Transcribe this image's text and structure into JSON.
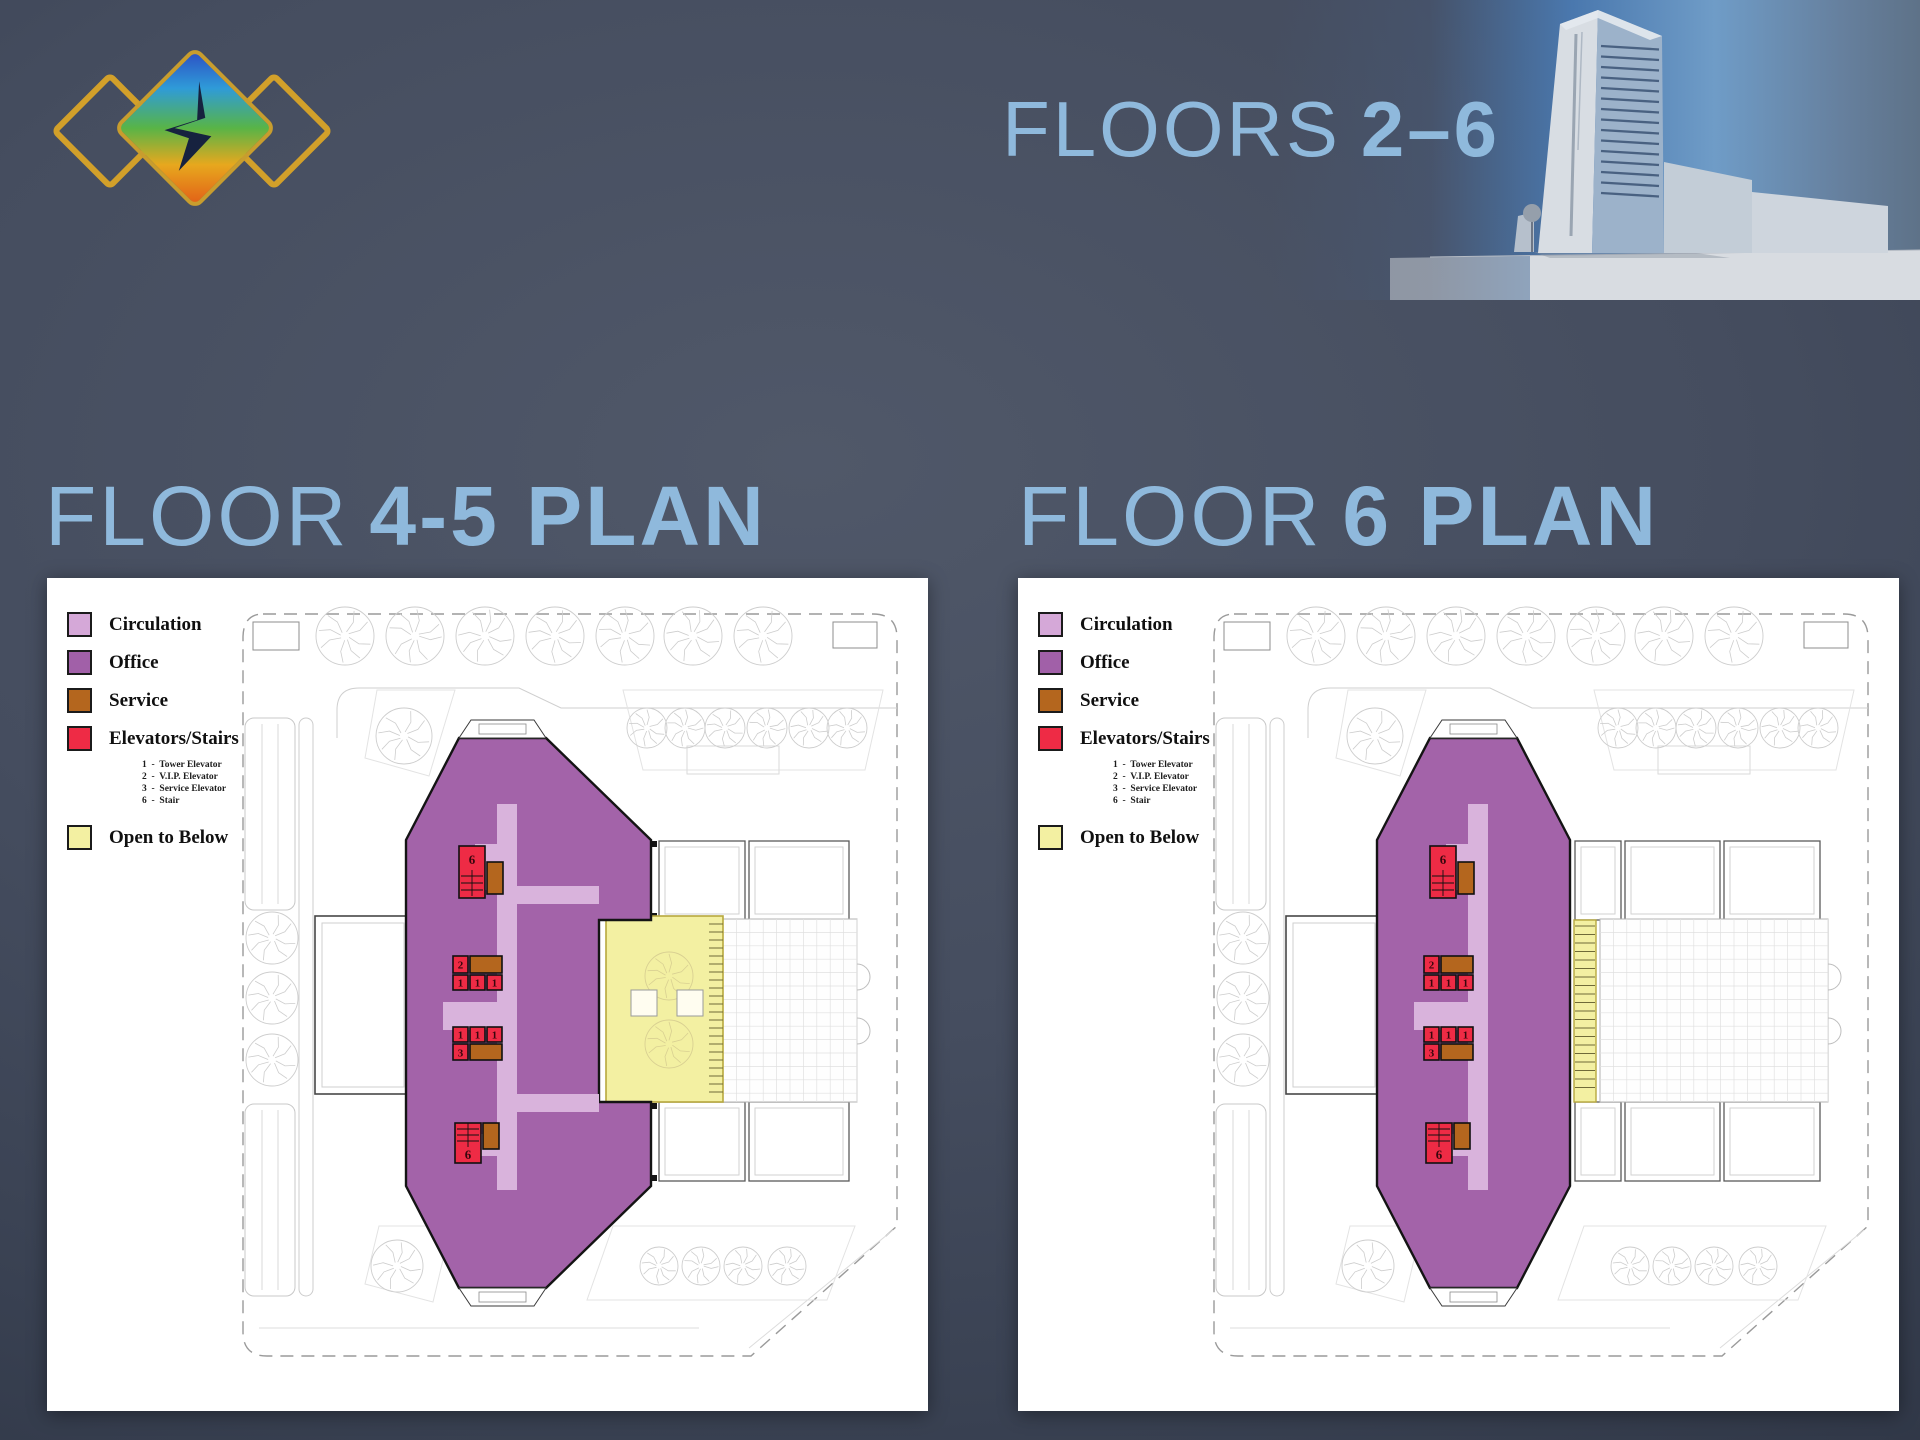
{
  "slide": {
    "title_regular": "FLOORS",
    "title_bold": "2–6"
  },
  "plans": [
    {
      "id": "floor45",
      "title_regular": "FLOOR",
      "title_bold": "4-5 PLAN"
    },
    {
      "id": "floor6",
      "title_regular": "FLOOR",
      "title_bold": "6 PLAN"
    }
  ],
  "legend": {
    "items": [
      {
        "key": "circulation",
        "label": "Circulation",
        "color": "#d5a8d8"
      },
      {
        "key": "office",
        "label": "Office",
        "color": "#a160a8"
      },
      {
        "key": "service",
        "label": "Service",
        "color": "#b4661e"
      },
      {
        "key": "elevators_stairs",
        "label": "Elevators/Stairs",
        "color": "#ee2b45",
        "sublist": [
          "1  -  Tower Elevator",
          "2  -  V.I.P. Elevator",
          "3  -  Service Elevator",
          "6  -  Stair"
        ]
      },
      {
        "key": "open_to_below",
        "label": "Open to Below",
        "color": "#f3f0a2"
      }
    ]
  },
  "elevator_labels": {
    "tower": "1",
    "vip": "2",
    "service_elevator": "3",
    "stair": "6"
  },
  "colors": {
    "title_blue": "#8fb9dc",
    "background": "#454d5f",
    "panel": "#ffffff",
    "circulation": "#d9b3dc",
    "office": "#a363a9",
    "service": "#b4661e",
    "elevator": "#ee2b45",
    "open_below": "#f3f0a2",
    "logo_gold": "#d2a02a",
    "sky_blue": "#4a78ae"
  }
}
